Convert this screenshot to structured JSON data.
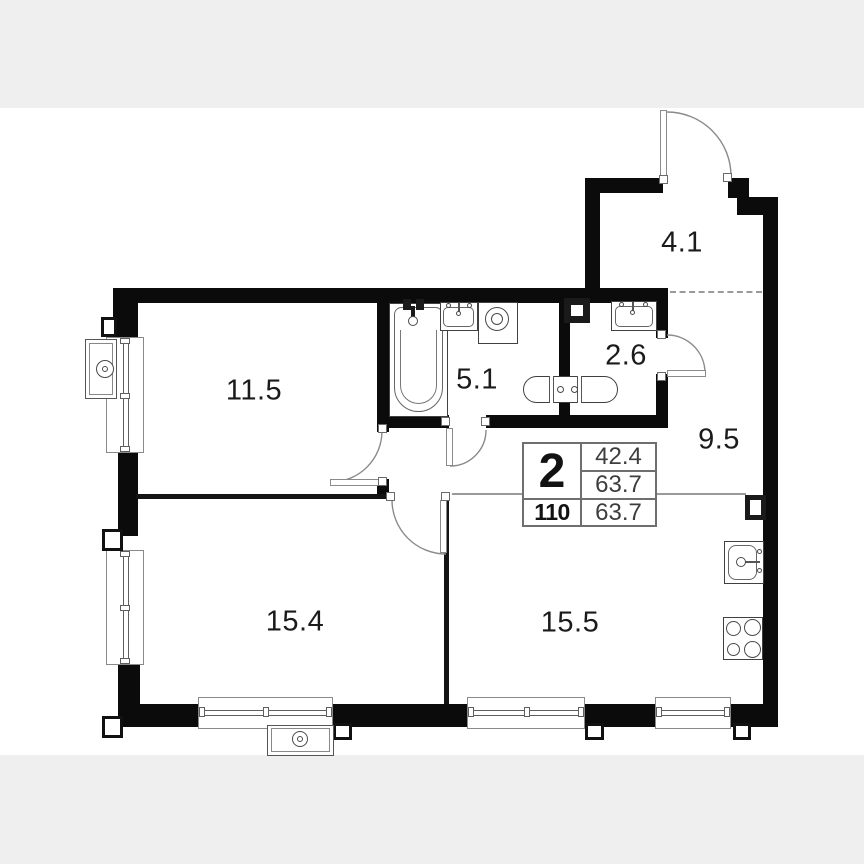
{
  "plan": {
    "rooms": [
      {
        "name": "bedroom",
        "area": "11.5"
      },
      {
        "name": "bathroom",
        "area": "5.1"
      },
      {
        "name": "toilet",
        "area": "2.6"
      },
      {
        "name": "entry-hall",
        "area": "4.1"
      },
      {
        "name": "corridor",
        "area": "9.5"
      },
      {
        "name": "living-room",
        "area": "15.4"
      },
      {
        "name": "kitchen-living-room",
        "area": "15.5"
      }
    ],
    "info_table": {
      "rooms_count": "2",
      "area_top": "42.4",
      "area_middle": "63.7",
      "apartment_number": "110",
      "area_bottom": "63.7"
    },
    "fixtures": [
      "bathtub",
      "bath-sink",
      "washing-machine",
      "toilet-pair",
      "wc-sink",
      "kitchen-sink",
      "stove",
      "air-conditioner-left",
      "air-conditioner-bottom",
      "vent-shaft-top",
      "vent-shaft-right"
    ],
    "colors": {
      "wall": "#0b0b0b",
      "background": "#ffffff",
      "margin_strip": "#efeff0",
      "boundary_line": "#9a9a9a",
      "label": "#1b1b1b"
    }
  }
}
